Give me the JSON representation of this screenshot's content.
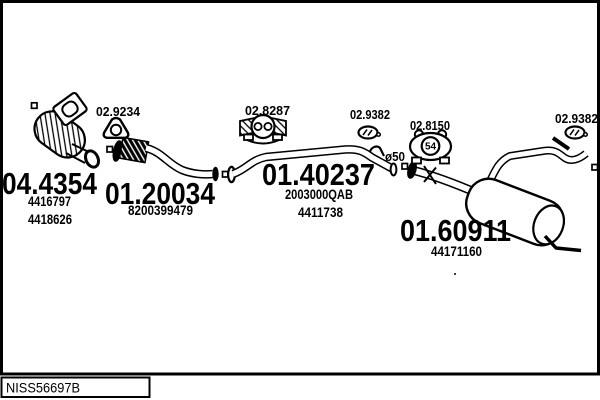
{
  "footer": {
    "code": "NISS56697B"
  },
  "parts": [
    {
      "code": "04.4354",
      "refs": [
        "4416797",
        "4418626"
      ]
    },
    {
      "code": "01.20034",
      "refs": [
        "8200399479"
      ]
    },
    {
      "code": "01.40237",
      "refs": [
        "2003000QAB",
        "4411738"
      ]
    },
    {
      "code": "01.60911",
      "refs": [
        "44171160"
      ]
    }
  ],
  "fittings": [
    {
      "code": "02.9234",
      "icon": "gasket-icon"
    },
    {
      "code": "02.8287",
      "icon": "clamp-bracket-icon"
    },
    {
      "code": "02.9382",
      "icon": "clamp-ring-icon"
    },
    {
      "code": "02.8150",
      "icon": "rubber-hanger-icon",
      "marking": "54"
    },
    {
      "code": "02.9382",
      "icon": "clamp-ring-icon"
    }
  ],
  "annotations": {
    "pipe_diameter": "ø50"
  },
  "colors": {
    "ink": "#000000",
    "background": "#ffffff"
  }
}
